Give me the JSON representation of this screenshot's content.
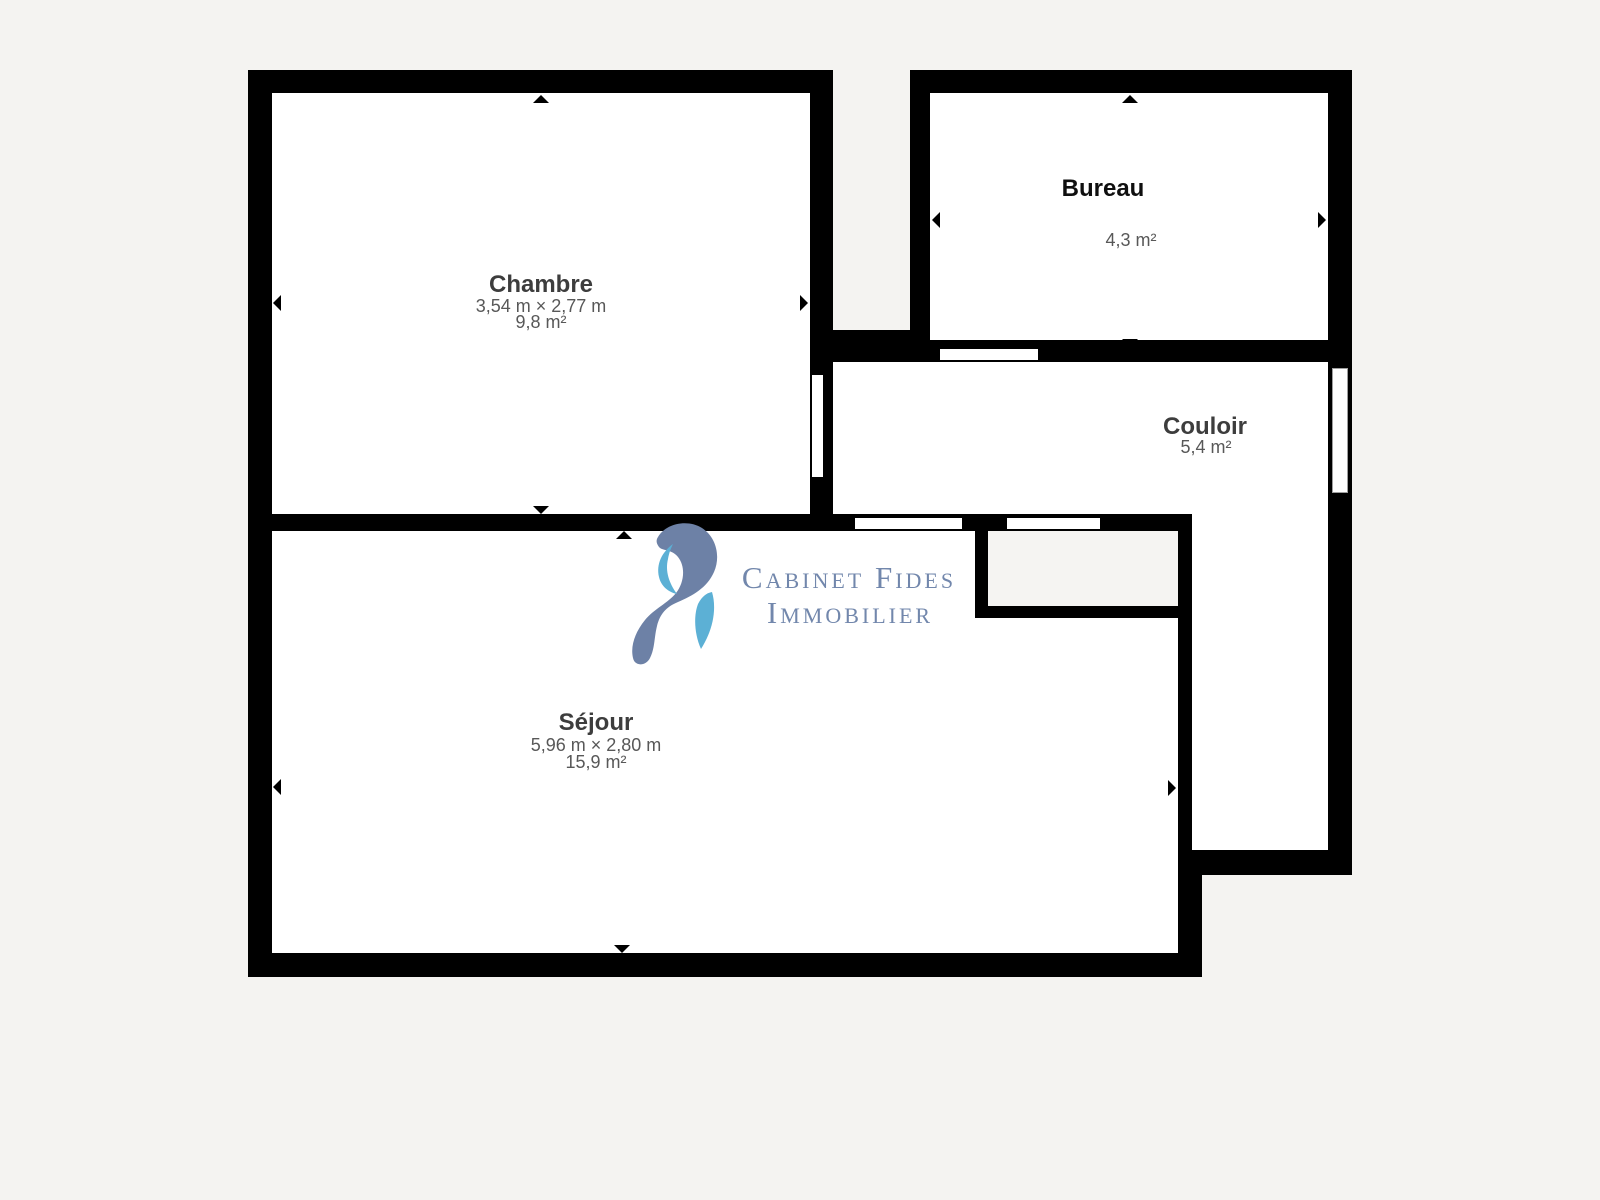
{
  "document": {
    "type": "floor-plan"
  },
  "branding": {
    "logo_line1": "Cabinet Fides",
    "logo_line2": "Immobilier"
  },
  "rooms": {
    "chambre": {
      "name": "Chambre",
      "dimensions": "3,54 m × 2,77 m",
      "area": "9,8 m²"
    },
    "bureau": {
      "name": "Bureau",
      "area": "4,3 m²"
    },
    "couloir": {
      "name": "Couloir",
      "area": "5,4 m²"
    },
    "sejour": {
      "name": "Séjour",
      "dimensions": "5,96 m × 2,80 m",
      "area": "15,9 m²"
    }
  },
  "colors": {
    "wall": "#000000",
    "page_bg": "#f4f3f1",
    "room_fill": "#ffffff",
    "closet_fill": "#f5f4f2",
    "room_label": "#3d3d3d",
    "bureau_label": "#0f0f0f",
    "room_sublabel": "#585858",
    "logo_text": "#7287ac",
    "logo_swirl": "#6d81a6",
    "logo_accent": "#5cb0d5",
    "window_border": "#9e9e9e"
  }
}
